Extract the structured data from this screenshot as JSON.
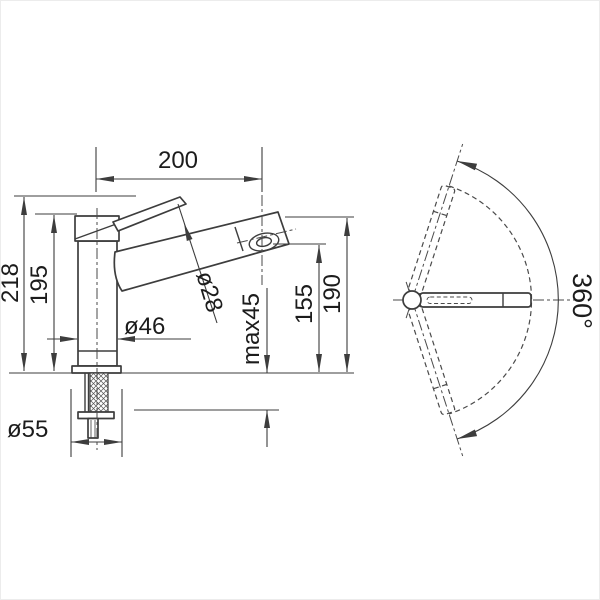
{
  "drawing": {
    "type": "technical-dimension-drawing",
    "subject": "kitchen faucet with pull-out spray: side elevation and top swivel view",
    "background": "#ffffff",
    "line_color": "#3d3d3d",
    "text_color": "#1c1c1c",
    "side_view": {
      "spout_reach": "200",
      "total_height": "218",
      "body_top_height": "195",
      "body_diameter": "ø46",
      "spout_tube_diameter": "ø28",
      "max_mounting_thickness": "max45",
      "outlet_height": "155",
      "spout_top_height": "190",
      "base_diameter": "ø55"
    },
    "top_view": {
      "swivel_range": "360°"
    }
  }
}
